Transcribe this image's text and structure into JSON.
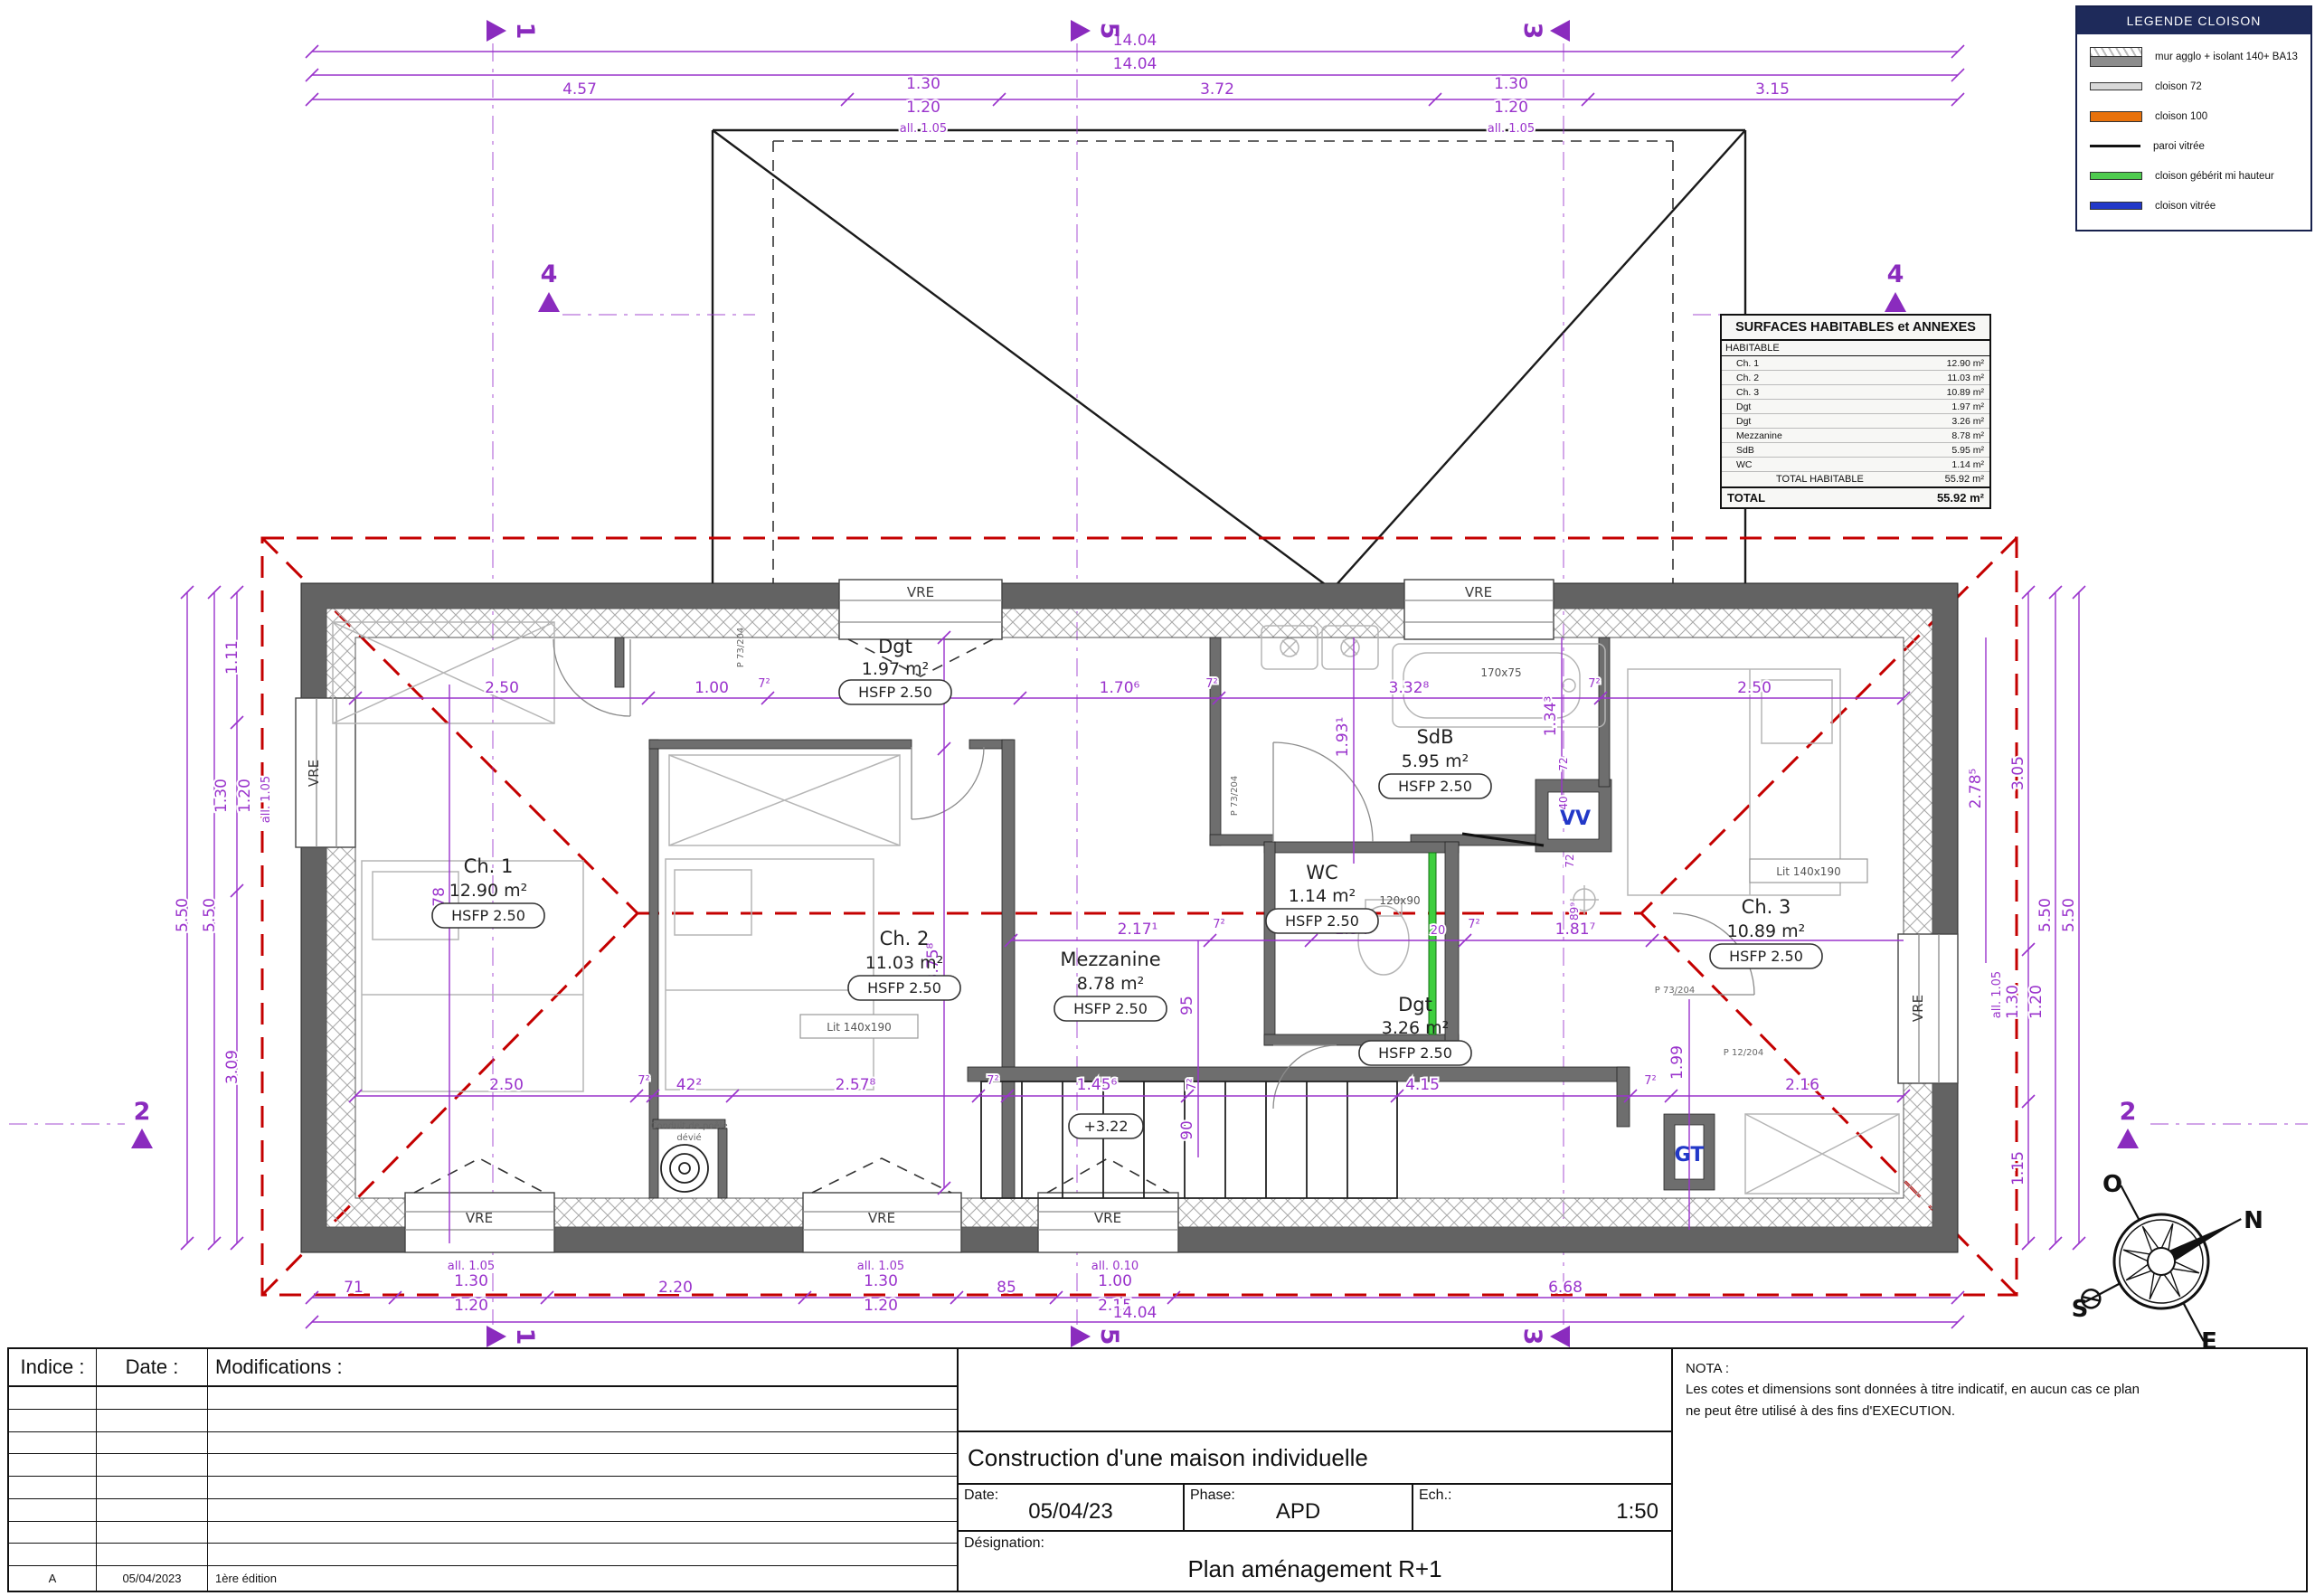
{
  "legend": {
    "title": "LEGENDE CLOISON",
    "items": [
      {
        "label": "mur agglo + isolant 140+ BA13"
      },
      {
        "label": "cloison 72"
      },
      {
        "label": "cloison 100"
      },
      {
        "label": "paroi vitrée"
      },
      {
        "label": "cloison gébérit mi hauteur"
      },
      {
        "label": "cloison vitrée"
      }
    ],
    "colors": {
      "mur": "#8d8d8d",
      "cloison72": "#d9d9d9",
      "cloison100": "#e8720c",
      "paroi": "#111111",
      "geberit": "#4ecb4e",
      "vitree": "#2238c8"
    }
  },
  "surfaces": {
    "title": "SURFACES HABITABLES et ANNEXES",
    "section": "HABITABLE",
    "rows": [
      {
        "label": "Ch. 1",
        "value": "12.90 m²"
      },
      {
        "label": "Ch. 2",
        "value": "11.03 m²"
      },
      {
        "label": "Ch. 3",
        "value": "10.89 m²"
      },
      {
        "label": "Dgt",
        "value": "1.97 m²"
      },
      {
        "label": "Dgt",
        "value": "3.26 m²"
      },
      {
        "label": "Mezzanine",
        "value": "8.78 m²"
      },
      {
        "label": "SdB",
        "value": "5.95 m²"
      },
      {
        "label": "WC",
        "value": "1.14 m²"
      }
    ],
    "subtotal": {
      "label": "TOTAL HABITABLE",
      "value": "55.92 m²"
    },
    "total": {
      "label": "TOTAL",
      "value": "55.92 m²"
    }
  },
  "rooms": [
    {
      "name": "Ch. 1",
      "area": "12.90 m²",
      "hsfp": "HSFP 2.50"
    },
    {
      "name": "Ch. 2",
      "area": "11.03 m²",
      "hsfp": "HSFP 2.50"
    },
    {
      "name": "Mezzanine",
      "area": "8.78 m²",
      "hsfp": "HSFP 2.50"
    },
    {
      "name": "SdB",
      "area": "5.95 m²",
      "hsfp": "HSFP 2.50"
    },
    {
      "name": "WC",
      "area": "1.14 m²",
      "hsfp": "HSFP 2.50"
    },
    {
      "name": "Dgt",
      "area": "1.97 m²",
      "hsfp": "HSFP 2.50"
    },
    {
      "name": "Dgt",
      "area": "3.26 m²",
      "hsfp": "HSFP 2.50"
    },
    {
      "name": "Ch. 3",
      "area": "10.89 m²",
      "hsfp": "HSFP 2.50"
    }
  ],
  "labels": {
    "vre": "VRE",
    "vv": "VV",
    "gt": "GT",
    "lit": "Lit 140x190",
    "bath": "170x75",
    "shower": "120x90",
    "conduit1": "Conduit de poêle",
    "conduit2": "dévié",
    "level": "+3.22",
    "door73": "P 73/204",
    "door12": "P 12/204"
  },
  "markers": {
    "s1": "1",
    "s2": "2",
    "s3": "3",
    "s4": "4",
    "s5": "5"
  },
  "compass": {
    "n": "N",
    "s": "S",
    "e": "E",
    "o": "O"
  },
  "dims": {
    "top": [
      "14.04",
      "14.04",
      "4.57",
      "1.30",
      "1.20",
      "all. 1.05",
      "3.72",
      "1.30",
      "1.20",
      "all. 1.05",
      "3.15"
    ],
    "bottom": [
      "71",
      "1.30",
      "1.20",
      "all. 1.05",
      "2.20",
      "1.30",
      "1.20",
      "all. 1.05",
      "85",
      "1.00",
      "2.15",
      "all. 0.10",
      "6.68",
      "14.04"
    ],
    "left": [
      "1.11",
      "1.30",
      "1.20",
      "all. 1.05",
      "5.50",
      "5.50",
      "3.09",
      "4.78"
    ],
    "right": [
      "3.05",
      "1.30",
      "1.20",
      "all. 1.05",
      "1.15",
      "5.50",
      "5.50",
      "2.78⁵"
    ],
    "inner": [
      "2.50",
      "1.00",
      "7²",
      "2.07²",
      "95",
      "1.70⁶",
      "7²",
      "1.93¹",
      "3.32⁸",
      "1.34³",
      "7²",
      "2.50",
      "2.17¹",
      "7²",
      "1.34⁴",
      "20",
      "7²",
      "1.81⁷",
      "95",
      "90",
      "2.50",
      "7²",
      "42²",
      "2.57⁸",
      "7²",
      "1.45⁶",
      "7²",
      "4.15",
      "7²",
      "2.16",
      "1.99",
      "3.75⁸",
      "72",
      "40",
      "72",
      "89⁹"
    ]
  },
  "title_block": {
    "indice_header": "Indice :",
    "date_header": "Date :",
    "modif_header": "Modifications :",
    "rev_indice": "A",
    "rev_date": "05/04/2023",
    "rev_modif": "1ère édition",
    "project": "Construction d'une maison individuelle",
    "date_label": "Date:",
    "date_value": "05/04/23",
    "phase_label": "Phase:",
    "phase_value": "APD",
    "ech_label": "Ech.:",
    "ech_value": "1:50",
    "designation_label": "Désignation:",
    "designation_value": "Plan aménagement R+1"
  },
  "nota": {
    "title": "NOTA :",
    "line1": "Les cotes et dimensions sont données à titre indicatif, en aucun cas ce plan",
    "line2": "ne peut être utilisé à des fins d'EXECUTION."
  }
}
